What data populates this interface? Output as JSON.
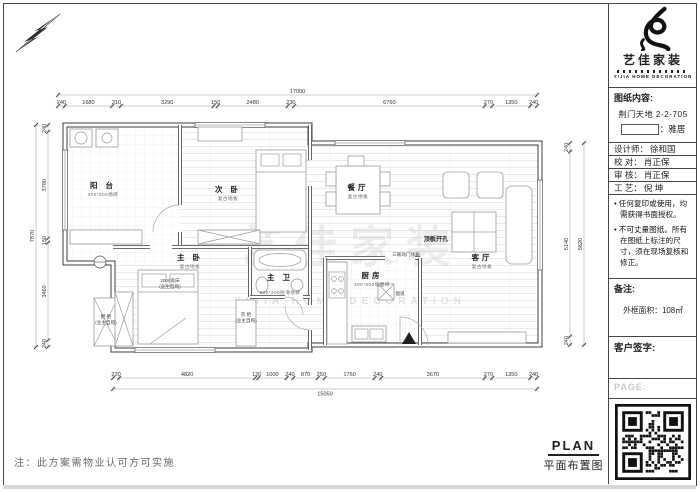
{
  "page": {
    "bottom_note": "注：此方案需物业认可方可实施"
  },
  "title_block": {
    "logo": {
      "name": "艺佳家装",
      "subtitle": "YIJIA HOME DECORATION"
    },
    "drawing_content": {
      "label": "图纸内容:",
      "project": "荆门天地 2-2-705",
      "style_suffix": "：雅居"
    },
    "rows": [
      {
        "label": "设计师：",
        "value": "徐和国"
      },
      {
        "label": "校 对：",
        "value": "肖正保"
      },
      {
        "label": "审 核：",
        "value": "肖正保"
      },
      {
        "label": "工 艺：",
        "value": "倪 坤"
      }
    ],
    "notices": [
      "• 任何复印或使用，均需获得书面授权。",
      "• 不可丈量图纸。所有在图纸上标注的尺寸，须在现场复核和修正。"
    ],
    "remark": {
      "label": "备注:",
      "area": "外框面积：108㎡"
    },
    "signature_label": "客户签字:",
    "page_label": "PAGE:"
  },
  "plan_title": {
    "en": "PLAN",
    "zh": "平面布置图"
  },
  "floor_plan": {
    "watermark": {
      "zh": "艺佳家装",
      "en": "YIJIA HOME DECORATION"
    },
    "rooms": {
      "balcony": {
        "name": "阳 台",
        "finish": "300*300地砖"
      },
      "second_bedroom": {
        "name": "次 卧",
        "finish": "复古地板"
      },
      "master_bedroom": {
        "name": "主 卧",
        "finish": "复古地板"
      },
      "master_bath": {
        "name": "主 卫",
        "finish": "300*300防滑地砖"
      },
      "dining": {
        "name": "餐厅",
        "finish": "复古地板"
      },
      "kitchen": {
        "name": "厨房",
        "finish": "300*600墙面砖"
      },
      "living": {
        "name": "客厅",
        "finish": "复古地板"
      }
    },
    "annotations": {
      "ceiling_hole": "顶板开孔",
      "door_box": "三联动门体箱",
      "bed": "2000宽床",
      "bed_note": "(业主自购)",
      "wardrobe": "衣 柜",
      "wardrobe_note": "(业主自购)",
      "shoe_cabinet": "鞋 柜",
      "shoe_note": "(业主自购)",
      "flue": "烟道"
    },
    "dimensions": {
      "top": {
        "overall": "17000",
        "segments": [
          "240",
          "1680",
          "310",
          "3290",
          "150",
          "2480",
          "230",
          "6760",
          "270",
          "1350",
          "240"
        ]
      },
      "bottom": {
        "overall": "15050",
        "segments": [
          "220",
          "4820",
          "120",
          "1000",
          "240",
          "870",
          "250",
          "1760",
          "240",
          "3670",
          "270",
          "1350",
          "240"
        ]
      },
      "left": {
        "overall": "7870",
        "segments": [
          "240",
          "3780",
          "150",
          "3460",
          "240"
        ]
      },
      "right": {
        "overall": "5620",
        "segments": [
          "240",
          "5140",
          "240"
        ]
      }
    }
  }
}
